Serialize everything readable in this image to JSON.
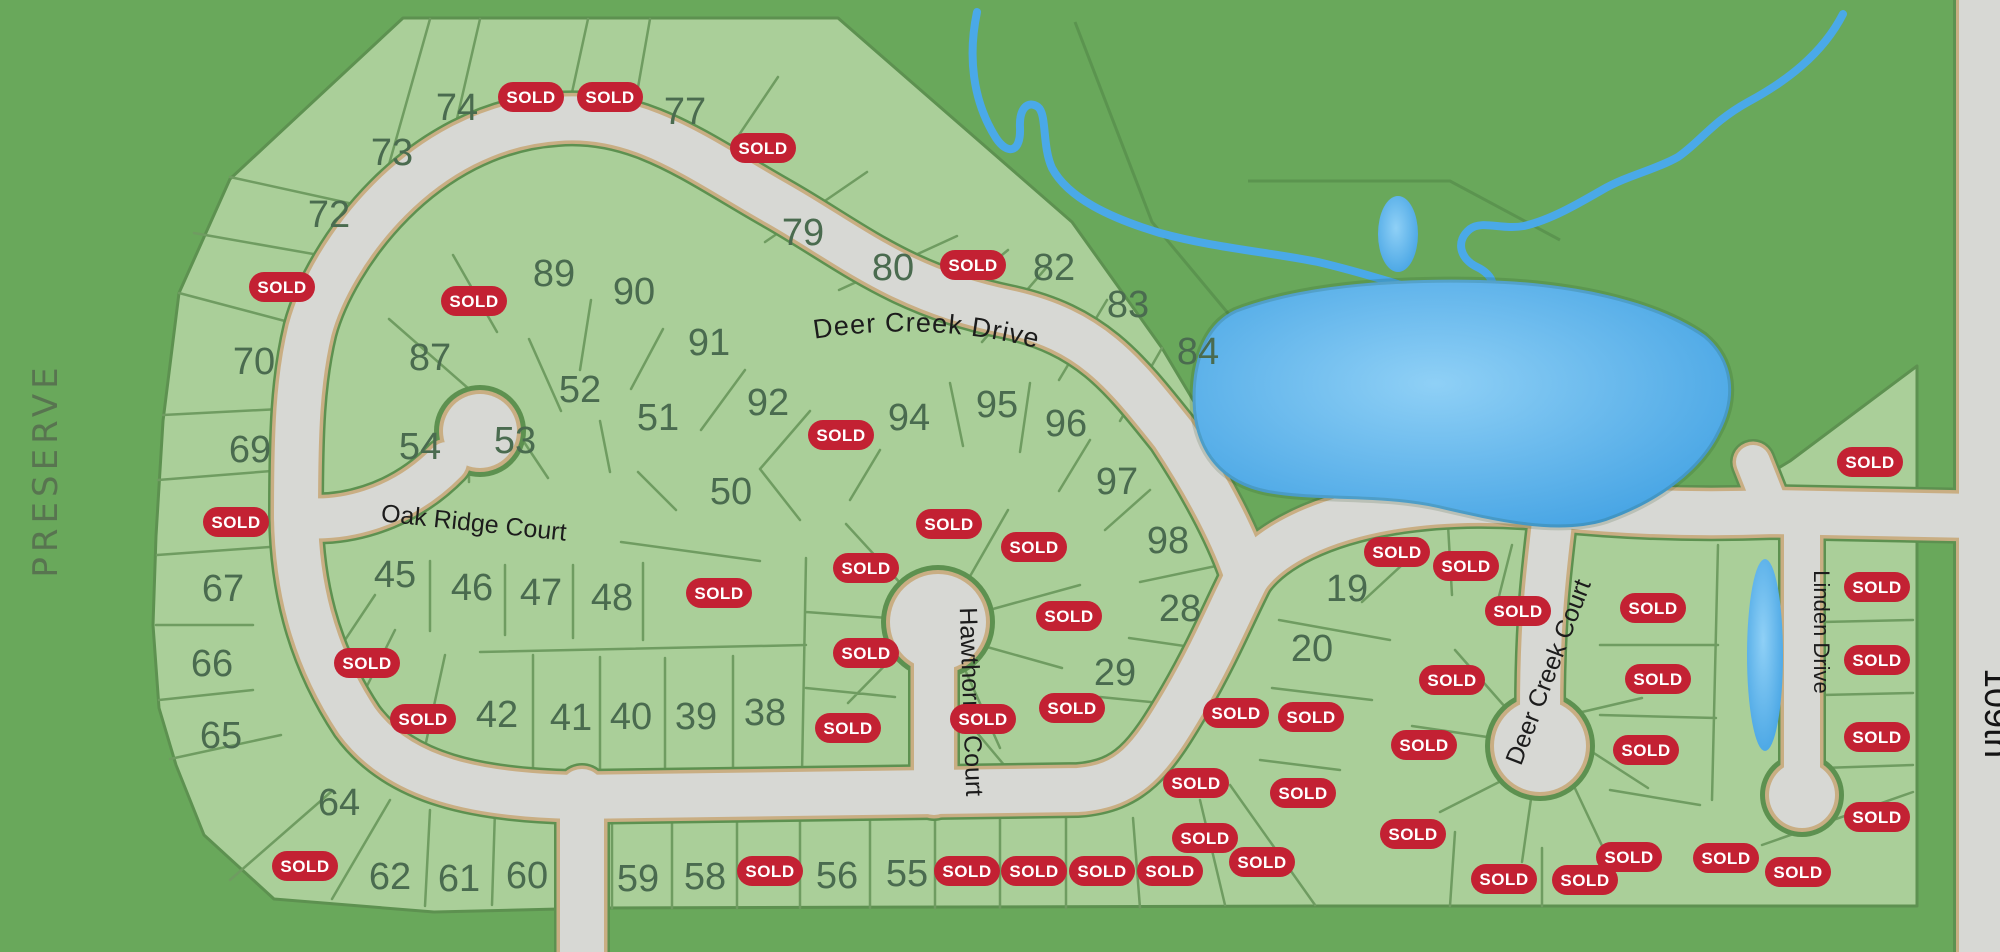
{
  "title": "Deer Creek subdivision plat map",
  "sold_label": "SOLD",
  "streets": {
    "deer_creek_drive": "Deer Creek Drive",
    "oak_ridge_court": "Oak Ridge Court",
    "hawthorne_court": "Hawthorne Court",
    "deer_creek_court": "Deer Creek Court",
    "linden_drive": "Linden Drive",
    "street_109th": "109th"
  },
  "area_labels": {
    "preserve": "PRESERVE"
  },
  "colors": {
    "preserve": "#69a85b",
    "lot": "#aacf99",
    "lot_line": "#6f9c61",
    "outline": "#5d9150",
    "road": "#d7d8d4",
    "casing": "#c9ae83",
    "sold": "#c32133",
    "sold_text": "#ffffff",
    "number": "#4a6b4f",
    "street_text": "#1c1c1c",
    "preserve_text": "#55684e",
    "water": "#46a4e4",
    "water_light": "#8fd0f6",
    "creek": "#4aa9e8"
  },
  "lots": [
    {
      "n": "74",
      "x": 457,
      "y": 107
    },
    {
      "n": "73",
      "x": 392,
      "y": 152
    },
    {
      "n": "72",
      "x": 329,
      "y": 214
    },
    {
      "n": "77",
      "x": 685,
      "y": 111
    },
    {
      "n": "79",
      "x": 803,
      "y": 232
    },
    {
      "n": "80",
      "x": 893,
      "y": 267
    },
    {
      "n": "82",
      "x": 1054,
      "y": 267
    },
    {
      "n": "83",
      "x": 1128,
      "y": 304
    },
    {
      "n": "84",
      "x": 1198,
      "y": 351
    },
    {
      "n": "70",
      "x": 254,
      "y": 361
    },
    {
      "n": "69",
      "x": 250,
      "y": 449
    },
    {
      "n": "67",
      "x": 223,
      "y": 588
    },
    {
      "n": "66",
      "x": 212,
      "y": 663
    },
    {
      "n": "65",
      "x": 221,
      "y": 735
    },
    {
      "n": "64",
      "x": 339,
      "y": 802
    },
    {
      "n": "62",
      "x": 390,
      "y": 876
    },
    {
      "n": "61",
      "x": 459,
      "y": 878
    },
    {
      "n": "60",
      "x": 527,
      "y": 875
    },
    {
      "n": "59",
      "x": 638,
      "y": 878
    },
    {
      "n": "58",
      "x": 705,
      "y": 876
    },
    {
      "n": "56",
      "x": 837,
      "y": 875
    },
    {
      "n": "55",
      "x": 907,
      "y": 873
    },
    {
      "n": "89",
      "x": 554,
      "y": 273
    },
    {
      "n": "90",
      "x": 634,
      "y": 291
    },
    {
      "n": "91",
      "x": 709,
      "y": 342
    },
    {
      "n": "92",
      "x": 768,
      "y": 402
    },
    {
      "n": "52",
      "x": 580,
      "y": 389
    },
    {
      "n": "51",
      "x": 658,
      "y": 417
    },
    {
      "n": "53",
      "x": 515,
      "y": 440
    },
    {
      "n": "54",
      "x": 420,
      "y": 446
    },
    {
      "n": "50",
      "x": 731,
      "y": 491
    },
    {
      "n": "87",
      "x": 430,
      "y": 357
    },
    {
      "n": "45",
      "x": 395,
      "y": 574
    },
    {
      "n": "46",
      "x": 472,
      "y": 587
    },
    {
      "n": "47",
      "x": 541,
      "y": 592
    },
    {
      "n": "48",
      "x": 612,
      "y": 597
    },
    {
      "n": "42",
      "x": 497,
      "y": 714
    },
    {
      "n": "41",
      "x": 571,
      "y": 717
    },
    {
      "n": "40",
      "x": 631,
      "y": 716
    },
    {
      "n": "39",
      "x": 696,
      "y": 716
    },
    {
      "n": "38",
      "x": 765,
      "y": 712
    },
    {
      "n": "94",
      "x": 909,
      "y": 417
    },
    {
      "n": "95",
      "x": 997,
      "y": 404
    },
    {
      "n": "96",
      "x": 1066,
      "y": 423
    },
    {
      "n": "97",
      "x": 1117,
      "y": 481
    },
    {
      "n": "98",
      "x": 1168,
      "y": 540
    },
    {
      "n": "28",
      "x": 1180,
      "y": 608
    },
    {
      "n": "29",
      "x": 1115,
      "y": 672
    },
    {
      "n": "19",
      "x": 1347,
      "y": 588
    },
    {
      "n": "20",
      "x": 1312,
      "y": 648
    }
  ],
  "sold_badges": [
    {
      "x": 531,
      "y": 97
    },
    {
      "x": 610,
      "y": 97
    },
    {
      "x": 763,
      "y": 148
    },
    {
      "x": 282,
      "y": 287
    },
    {
      "x": 474,
      "y": 301
    },
    {
      "x": 973,
      "y": 265
    },
    {
      "x": 236,
      "y": 522
    },
    {
      "x": 367,
      "y": 663
    },
    {
      "x": 423,
      "y": 719
    },
    {
      "x": 305,
      "y": 866
    },
    {
      "x": 719,
      "y": 593
    },
    {
      "x": 841,
      "y": 435
    },
    {
      "x": 949,
      "y": 524
    },
    {
      "x": 1034,
      "y": 547
    },
    {
      "x": 866,
      "y": 568
    },
    {
      "x": 866,
      "y": 653
    },
    {
      "x": 848,
      "y": 728
    },
    {
      "x": 983,
      "y": 719
    },
    {
      "x": 1072,
      "y": 708
    },
    {
      "x": 1069,
      "y": 616
    },
    {
      "x": 1236,
      "y": 713
    },
    {
      "x": 1303,
      "y": 793
    },
    {
      "x": 1262,
      "y": 862
    },
    {
      "x": 770,
      "y": 871
    },
    {
      "x": 967,
      "y": 871
    },
    {
      "x": 1034,
      "y": 871
    },
    {
      "x": 1102,
      "y": 871
    },
    {
      "x": 1170,
      "y": 871
    },
    {
      "x": 1205,
      "y": 838
    },
    {
      "x": 1196,
      "y": 783
    },
    {
      "x": 1413,
      "y": 834
    },
    {
      "x": 1504,
      "y": 879
    },
    {
      "x": 1585,
      "y": 880
    },
    {
      "x": 1397,
      "y": 552
    },
    {
      "x": 1466,
      "y": 566
    },
    {
      "x": 1518,
      "y": 611
    },
    {
      "x": 1452,
      "y": 680
    },
    {
      "x": 1311,
      "y": 717
    },
    {
      "x": 1424,
      "y": 745
    },
    {
      "x": 1653,
      "y": 608
    },
    {
      "x": 1658,
      "y": 679
    },
    {
      "x": 1646,
      "y": 750
    },
    {
      "x": 1629,
      "y": 857
    },
    {
      "x": 1726,
      "y": 858
    },
    {
      "x": 1798,
      "y": 872
    },
    {
      "x": 1870,
      "y": 462
    },
    {
      "x": 1877,
      "y": 587
    },
    {
      "x": 1877,
      "y": 660
    },
    {
      "x": 1877,
      "y": 737
    },
    {
      "x": 1877,
      "y": 817
    }
  ]
}
